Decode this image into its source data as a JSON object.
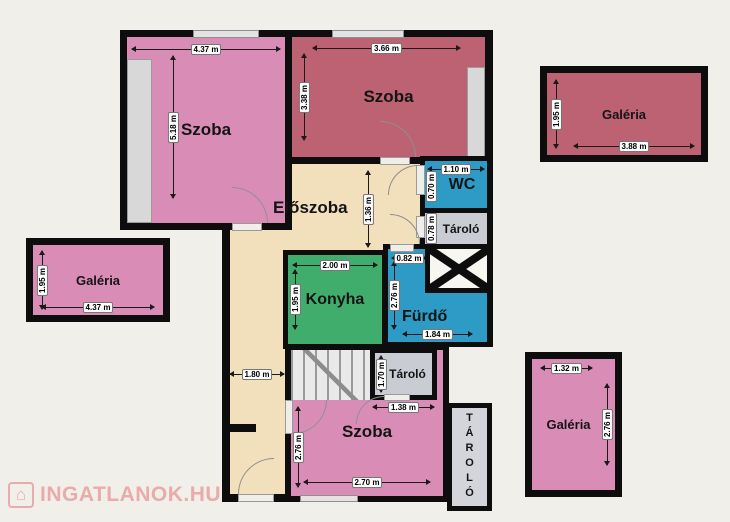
{
  "watermark": {
    "text": "INGATLANOK.HU",
    "icon_glyph": "⌂"
  },
  "rooms": {
    "szoba_tl": {
      "label": "Szoba",
      "width": "4.37 m",
      "height": "5.18 m"
    },
    "szoba_tm": {
      "label": "Szoba",
      "width": "3.66 m",
      "height": "3.38 m"
    },
    "galeria_r": {
      "label": "Galéria",
      "width": "3.88 m",
      "height": "1.95 m"
    },
    "galeria_l": {
      "label": "Galéria",
      "width": "4.37 m",
      "height": "1.95 m"
    },
    "eloszoba": {
      "label": "Előszoba",
      "depth": "1.36 m",
      "corridor_width": "1.80 m"
    },
    "konyha": {
      "label": "Konyha",
      "width": "2.00 m",
      "height": "1.95 m"
    },
    "wc": {
      "label": "WC",
      "width": "1.10 m",
      "height": "0.70 m"
    },
    "tarolo_felso": {
      "label": "Tároló",
      "height": "0.78 m"
    },
    "furdo": {
      "label": "Fürdő",
      "top_width": "0.82 m",
      "height": "2.76 m",
      "width": "1.84 m"
    },
    "tarolo_kozep": {
      "label": "Tároló",
      "height": "1.70 m",
      "width": "1.38 m"
    },
    "szoba_also": {
      "label": "Szoba",
      "width": "2.70 m",
      "height": "2.76 m"
    },
    "tarolo_also": {
      "label": "TÁROLÓ"
    },
    "galeria_br": {
      "label": "Galéria",
      "width": "1.32 m",
      "height": "2.76 m"
    }
  },
  "colors": {
    "room_pink": "#d98db6",
    "room_dark_red": "#bd6272",
    "hall_beige": "#f2dfbc",
    "kitchen_green": "#41ad6d",
    "bath_blue": "#2e9bc6",
    "storage_gray": "#caccd4",
    "wall_black": "#0d0d0d",
    "background": "#f0efe9",
    "watermark_pink": "#eaabab"
  }
}
